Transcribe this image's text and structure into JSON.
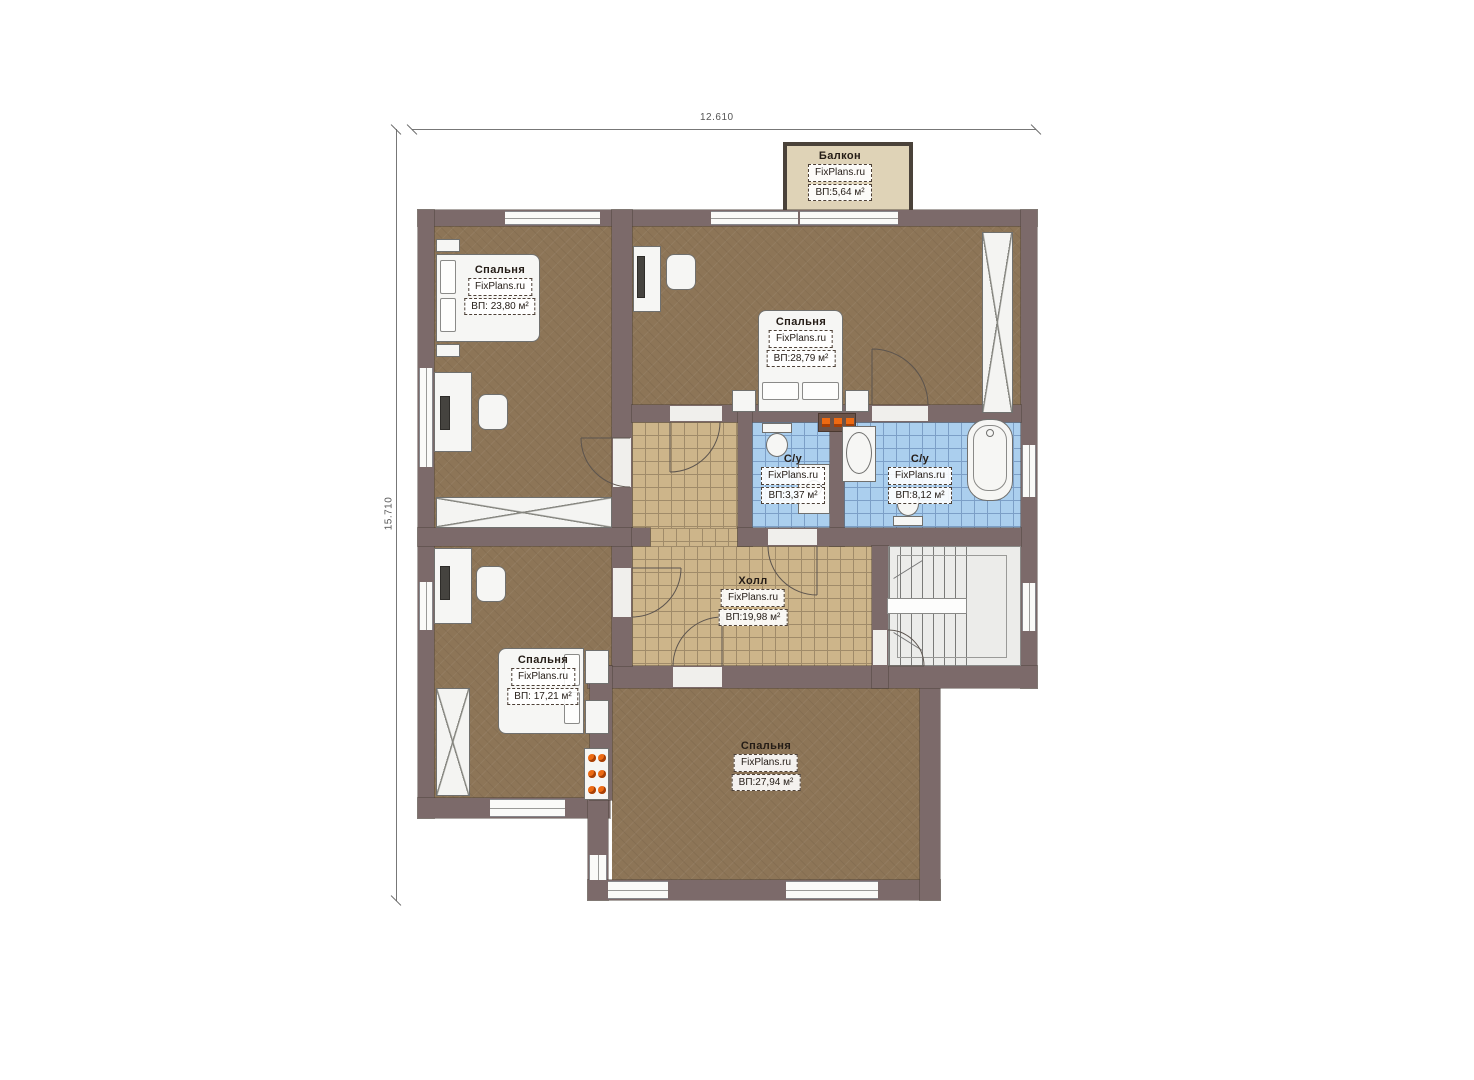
{
  "dimensions": {
    "top": "12.610",
    "left": "15.710"
  },
  "brand": "FixPlans.ru",
  "rooms": [
    {
      "id": "balcony",
      "name": "Балкон",
      "area": "ВП:5,64 м²"
    },
    {
      "id": "bedroom-top-left",
      "name": "Спальня",
      "area": "ВП: 23,80 м²"
    },
    {
      "id": "bedroom-top-right",
      "name": "Спальня",
      "area": "ВП:28,79 м²"
    },
    {
      "id": "bathroom-small",
      "name": "С/у",
      "area": "ВП:3,37 м²"
    },
    {
      "id": "bathroom-large",
      "name": "С/у",
      "area": "ВП:8,12 м²"
    },
    {
      "id": "hall",
      "name": "Холл",
      "area": "ВП:19,98 м²"
    },
    {
      "id": "bedroom-bottom-left",
      "name": "Спальня",
      "area": "ВП: 17,21 м²"
    },
    {
      "id": "bedroom-bottom",
      "name": "Спальня",
      "area": "ВП:27,94 м²"
    }
  ],
  "colors": {
    "wall": "#7c6a6a",
    "carpet": "#8d7557",
    "tile_tan": "#cdb58a",
    "tile_blue": "#abcfee",
    "balcony_floor": "#dfd3b7",
    "radiator": "#ed6a12"
  }
}
